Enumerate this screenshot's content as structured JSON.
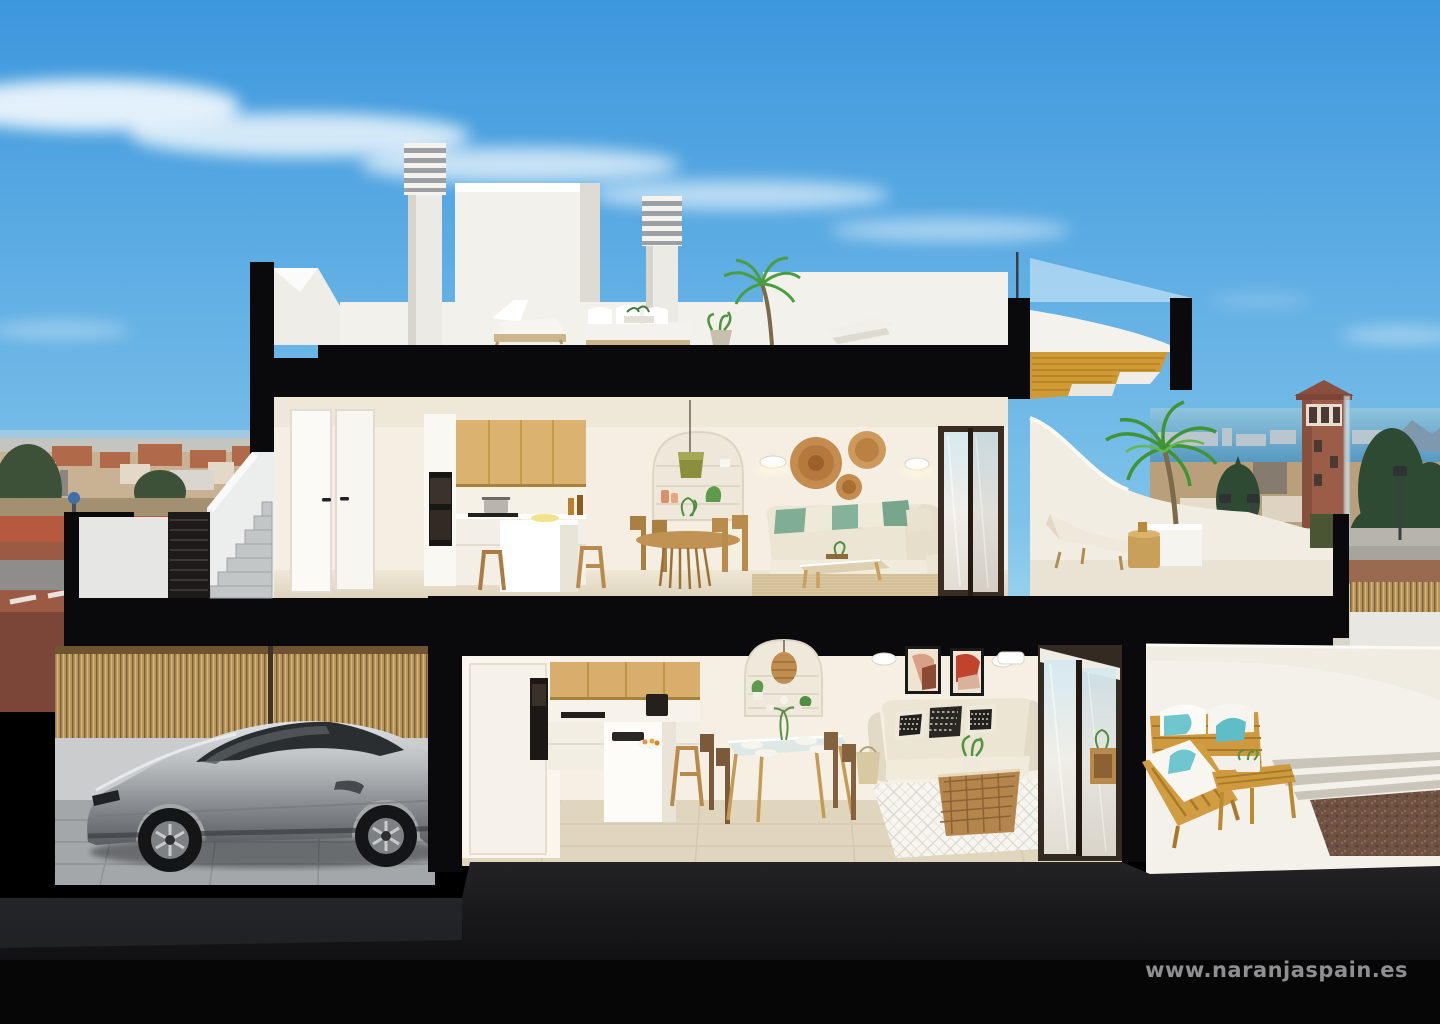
{
  "page": {
    "title": "3D cut-away section render of a two-storey Mediterranean villa"
  },
  "watermark": {
    "text": "www.naranjaspain.es"
  },
  "palette": {
    "sky_top": "#3d97dd",
    "sky_horizon": "#b8e2f2",
    "cut_black": "#0a0a0c",
    "wall_white": "#f2efe9",
    "interior_cream": "#f5eee1",
    "wood_cabinet": "#d9ad6c",
    "wood_furniture": "#c9973f",
    "cushion_green": "#7fae95",
    "cushion_turquoise": "#6fc6cf",
    "terracotta_art": "#c96f4a",
    "car_silver": "#b9bcbf",
    "sea_blue": "#5f9fc5",
    "bamboo": "#b4935c",
    "watermark_gray": "#8f8f91"
  },
  "scene": {
    "type": "cutaway-section-render",
    "sky": {
      "clouds": "white wispy streak upper left, faint wisps right"
    },
    "background": {
      "left": "town with terracotta roofs, trees, red paved street with crosswalk",
      "right": "sea with distant skyline, mountains, brick watchtower, conifer trees, lamp posts, dirt lot, roads"
    },
    "levels": [
      {
        "name": "roof-terrace",
        "objects": [
          "chimney with louvre cap",
          "second chimney",
          "stair housing block",
          "white lounge chair",
          "white outdoor sofa",
          "potted plant",
          "palm tree",
          "white parapet walls",
          "curved canopy with wood-slat soffit",
          "glass balustrade"
        ]
      },
      {
        "name": "upper-floor",
        "objects": [
          "two white interior doors",
          "oak upper cabinets",
          "built-in black oven",
          "white kitchen island with two wooden stools",
          "arched shelf niche",
          "olive pendant lamp",
          "round wood dining table with four rattan chairs",
          "two wall sconces",
          "three rattan wall baskets",
          "cream L-shaped sofa with green cushions",
          "wood-glass coffee table",
          "jute rug",
          "dark-framed sliding glass door",
          "terrace with potted palm, sun lounger and gold side table"
        ]
      },
      {
        "name": "ground-floor",
        "objects": [
          "garage with silver sports coupe",
          "bamboo slat fence",
          "oak upper cabinets",
          "black oven column",
          "white island with sink and fruit bowl",
          "wooden stool",
          "glass dining table with four chairs",
          "arched niche with rattan pendant",
          "two abstract terracotta artworks",
          "two wall sconces",
          "air-conditioning unit",
          "cream sofa with black-white cushions",
          "rattan basket coffee table with plant",
          "white diamond-pattern rug",
          "sliding glass doors",
          "terrace with wooden sofa, wooden chaise, slat bench table, turquoise pillows",
          "stepping stones",
          "gravel bed"
        ]
      }
    ],
    "exterior": [
      "external staircase with white walls",
      "black louvred gate",
      "street with red paving",
      "dark ground"
    ]
  }
}
